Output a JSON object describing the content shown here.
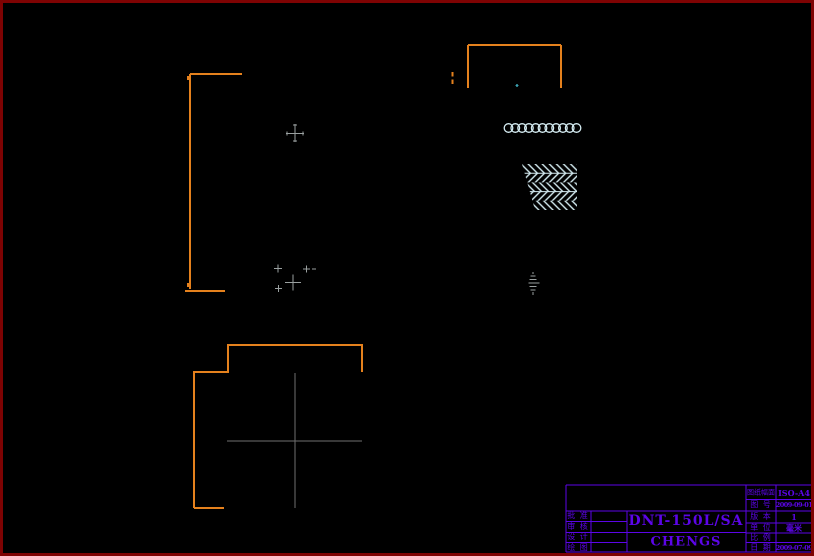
{
  "colors": {
    "background": "#000000",
    "frame": "#7e0303",
    "accent_orange": "#e5811d",
    "pale_cyan": "#d5ecf2",
    "marker_gray": "#9aa0a0",
    "centerline_gray": "#6f6f6f",
    "titleblock_purple": "#5c05e8",
    "dot_teal": "#3aa0b0"
  },
  "title_block": {
    "part_number": "DNT-150L/SA",
    "drawn_by": "CHENGS",
    "sign_rows": [
      {
        "label": "批 准"
      },
      {
        "label": "审 核"
      },
      {
        "label": "设 计"
      },
      {
        "label": "绘 图"
      }
    ],
    "info_rows": [
      {
        "label": "图纸幅面",
        "value": "ISO-A4"
      },
      {
        "label": "图 号",
        "value": "2009-09-01"
      },
      {
        "label": "版 本",
        "value": "1"
      },
      {
        "label": "单 位",
        "value": "毫米"
      },
      {
        "label": "比 例",
        "value": ""
      },
      {
        "label": "日 期",
        "value": "2009-07-09"
      }
    ]
  }
}
